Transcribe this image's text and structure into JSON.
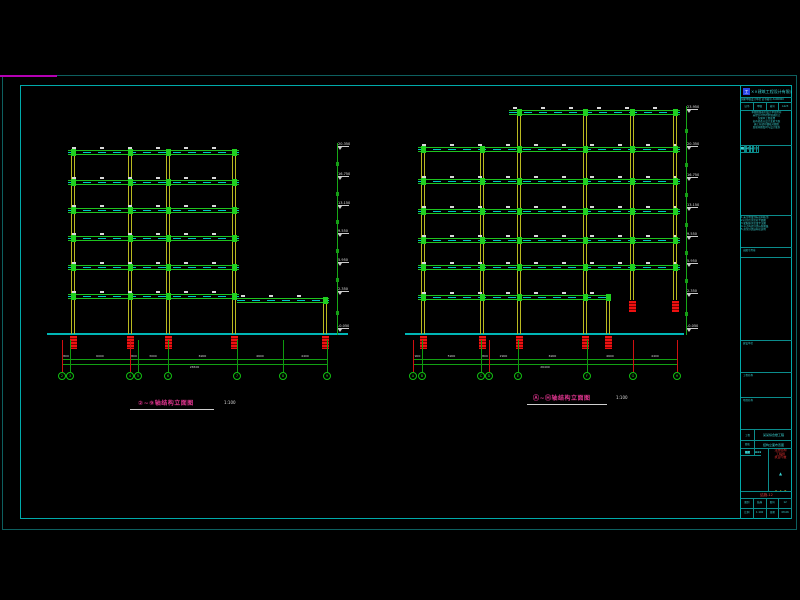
{
  "frame": {
    "outer_color": "#0d5f5f",
    "inner_color": "#00aaaa",
    "magenta_color": "#b400b4"
  },
  "drawings": {
    "left": {
      "title": "②~⑨轴结构立面图",
      "scale": "1:100",
      "ground": {
        "x1": 47,
        "x2": 348,
        "y": 333
      },
      "columns": [
        {
          "x": 73,
          "y1": 150,
          "y2": 334
        },
        {
          "x": 130,
          "y1": 150,
          "y2": 334
        },
        {
          "x": 168,
          "y1": 150,
          "y2": 334
        },
        {
          "x": 234,
          "y1": 150,
          "y2": 334
        },
        {
          "x": 325,
          "y1": 299,
          "y2": 334
        }
      ],
      "beams": [
        {
          "y": 152,
          "x1": 68,
          "x2": 239
        },
        {
          "y": 182,
          "x1": 68,
          "x2": 239
        },
        {
          "y": 210,
          "x1": 68,
          "x2": 239
        },
        {
          "y": 238,
          "x1": 68,
          "x2": 239
        },
        {
          "y": 267,
          "x1": 68,
          "x2": 239
        },
        {
          "y": 296,
          "x1": 68,
          "x2": 239
        },
        {
          "y": 300,
          "x1": 237,
          "x2": 329
        }
      ],
      "footings": [
        {
          "x": 73,
          "y": 336
        },
        {
          "x": 130,
          "y": 336
        },
        {
          "x": 168,
          "y": 336
        },
        {
          "x": 234,
          "y": 336
        },
        {
          "x": 325,
          "y": 336
        }
      ],
      "hanging": [],
      "elev": {
        "x": 337,
        "y1": 143,
        "y2": 335,
        "flags": [
          {
            "y": 147,
            "label": "20.350"
          },
          {
            "y": 177,
            "label": "16.750"
          },
          {
            "y": 206,
            "label": "13.150"
          },
          {
            "y": 234,
            "label": "9.550"
          },
          {
            "y": 263,
            "label": "5.950"
          },
          {
            "y": 292,
            "label": "2.350"
          },
          {
            "y": 329,
            "label": "-0.050"
          }
        ]
      },
      "dims": {
        "y1": 359,
        "y2": 364,
        "xs": [
          62,
          70,
          130,
          138,
          168,
          237,
          283,
          327
        ],
        "segs": [
          "800",
          "6000",
          "800",
          "3000",
          "6900",
          "4600",
          "4400"
        ],
        "total": "26500",
        "ext_red_idx": [
          0,
          2
        ]
      },
      "bubbles": {
        "y": 372,
        "items": [
          {
            "x": 62,
            "label": "2"
          },
          {
            "x": 70,
            "label": "3"
          },
          {
            "x": 130,
            "label": "4"
          },
          {
            "x": 138,
            "label": "5"
          },
          {
            "x": 168,
            "label": "6"
          },
          {
            "x": 237,
            "label": "7"
          },
          {
            "x": 283,
            "label": "8"
          },
          {
            "x": 327,
            "label": "9"
          }
        ]
      },
      "title_pos": {
        "x": 138,
        "y": 398,
        "ux": 130,
        "uw": 84,
        "sx": 224
      }
    },
    "right": {
      "title": "Ⓐ~Ⓗ轴结构立面图",
      "scale": "1:100",
      "ground": {
        "x1": 405,
        "x2": 684,
        "y": 333
      },
      "columns": [
        {
          "x": 423,
          "y1": 148,
          "y2": 334
        },
        {
          "x": 482,
          "y1": 148,
          "y2": 334
        },
        {
          "x": 519,
          "y1": 110,
          "y2": 334
        },
        {
          "x": 585,
          "y1": 110,
          "y2": 334
        },
        {
          "x": 608,
          "y1": 299,
          "y2": 334
        },
        {
          "x": 632,
          "y1": 110,
          "y2": 300
        },
        {
          "x": 675,
          "y1": 110,
          "y2": 300
        }
      ],
      "beams": [
        {
          "y": 112,
          "x1": 509,
          "x2": 680
        },
        {
          "y": 149,
          "x1": 418,
          "x2": 680
        },
        {
          "y": 181,
          "x1": 418,
          "x2": 680
        },
        {
          "y": 211,
          "x1": 418,
          "x2": 680
        },
        {
          "y": 240,
          "x1": 418,
          "x2": 680
        },
        {
          "y": 267,
          "x1": 418,
          "x2": 680
        },
        {
          "y": 297,
          "x1": 418,
          "x2": 611
        }
      ],
      "footings": [
        {
          "x": 423,
          "y": 336
        },
        {
          "x": 482,
          "y": 336
        },
        {
          "x": 519,
          "y": 336
        },
        {
          "x": 585,
          "y": 336
        },
        {
          "x": 608,
          "y": 336
        }
      ],
      "hanging": [
        {
          "x": 632,
          "y": 301
        },
        {
          "x": 675,
          "y": 301
        }
      ],
      "elev": {
        "x": 686,
        "y1": 106,
        "y2": 335,
        "flags": [
          {
            "y": 110,
            "label": "23.950"
          },
          {
            "y": 147,
            "label": "20.350"
          },
          {
            "y": 178,
            "label": "16.750"
          },
          {
            "y": 208,
            "label": "13.150"
          },
          {
            "y": 237,
            "label": "9.550"
          },
          {
            "y": 264,
            "label": "5.950"
          },
          {
            "y": 294,
            "label": "2.350"
          },
          {
            "y": 329,
            "label": "-0.050"
          }
        ]
      },
      "dims": {
        "y1": 359,
        "y2": 364,
        "xs": [
          413,
          422,
          481,
          489,
          518,
          587,
          633,
          677
        ],
        "segs": [
          "900",
          "5900",
          "800",
          "2900",
          "6900",
          "4600",
          "4400"
        ],
        "total": "26400",
        "ext_red_idx": [
          0,
          3,
          6,
          7
        ]
      },
      "bubbles": {
        "y": 372,
        "items": [
          {
            "x": 413,
            "label": "A"
          },
          {
            "x": 422,
            "label": "B"
          },
          {
            "x": 481,
            "label": "C"
          },
          {
            "x": 489,
            "label": "D"
          },
          {
            "x": 518,
            "label": "E"
          },
          {
            "x": 587,
            "label": "F"
          },
          {
            "x": 633,
            "label": "G"
          },
          {
            "x": 677,
            "label": "H"
          }
        ]
      },
      "title_pos": {
        "x": 533,
        "y": 393,
        "ux": 527,
        "uw": 80,
        "sx": 616
      }
    }
  },
  "title_block": {
    "company": "××建筑工程设计有限公司",
    "cert_line": "国家甲级设计单位 证书编号 A100000",
    "header_cells": [
      "证书",
      "甲级",
      "编号",
      "A123"
    ],
    "notes_lines": [
      "本图纸版权归设计单位所有",
      "未经许可不得复制或转让",
      "仅限本工程使用",
      "如有修改以设计变更为准",
      "施工前请仔细核对图纸",
      "发现问题及时与设计联系"
    ],
    "table_title": "会 签 栏",
    "table_cols": [
      "专业",
      "签名",
      "日期"
    ],
    "table_rows": [
      [
        "建筑",
        "—",
        "—"
      ],
      [
        "结构",
        "—",
        "—"
      ],
      [
        "给排水",
        "—",
        "—"
      ],
      [
        "电气",
        "—",
        "—"
      ],
      [
        "暖通",
        "—",
        "—"
      ],
      [
        "动力",
        "—",
        "—"
      ],
      [
        "总图",
        "—",
        "—"
      ],
      [
        "概算",
        "—",
        "—"
      ]
    ],
    "notes2_lines": [
      "1.未注明梁顶标高同板顶",
      "2.柱定位详见柱平面图",
      "3.梁配筋详见梁平法图",
      "4.节点构造详见标准图集",
      "5.其余详见结构总说明"
    ],
    "seal_box_label": "出图专用章",
    "owner_box_label": "建设单位",
    "project_box_label": "工程名称",
    "name_box_label": "项目名称",
    "kv1_label": "工程",
    "kv1_value": "某某综合楼工程",
    "kv2_label": "图名",
    "kv2_value": "结构立面布置图",
    "signoff_rows": [
      [
        "审定",
        "×××"
      ],
      [
        "审核",
        "×××"
      ],
      [
        "校对",
        "×××"
      ],
      [
        "设计",
        "×××"
      ],
      [
        "制图",
        "×××"
      ],
      [
        "负责",
        "×××"
      ]
    ],
    "stamp_red_lines": [
      "注册结构",
      "工程师",
      "执业印章"
    ],
    "stamp_triangle": "▲",
    "stamp_yellow": "1.A.S",
    "stamp_glyph": "签",
    "drawing_no_red": "结施-12",
    "bottom_cells_row1": [
      "图别",
      "结施",
      "图号",
      "12"
    ],
    "bottom_cells_row2": [
      "比例",
      "1:100",
      "日期",
      "08.06"
    ]
  }
}
